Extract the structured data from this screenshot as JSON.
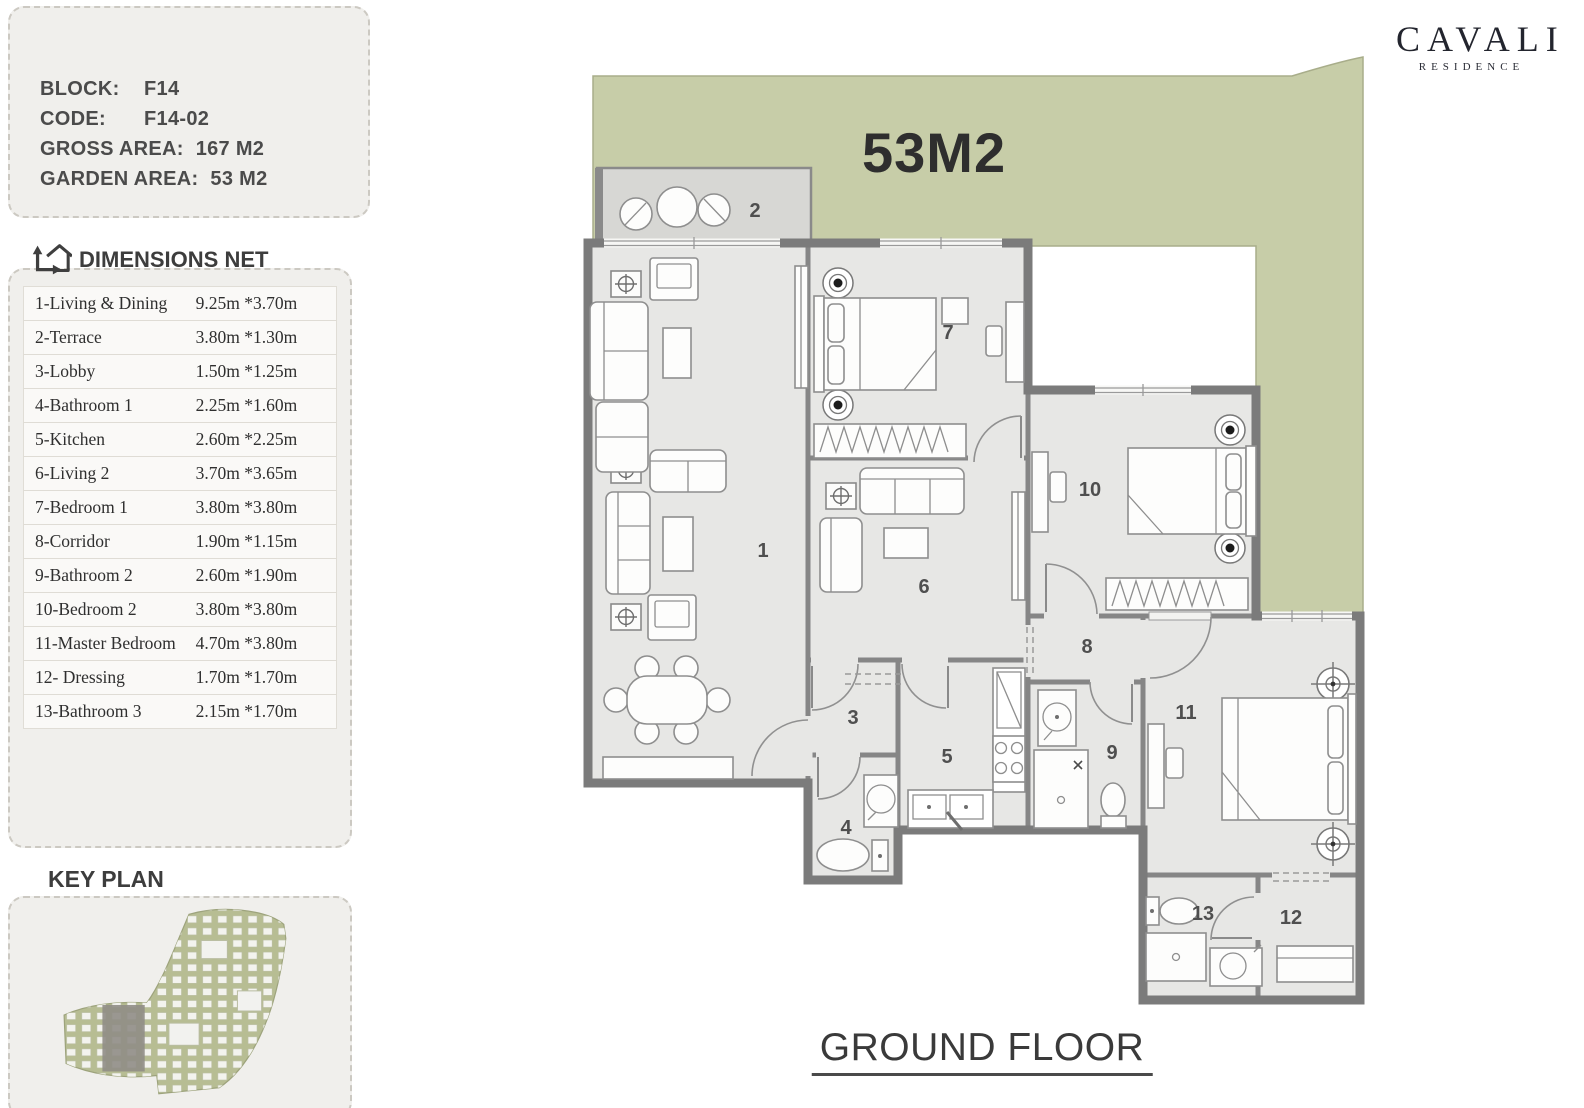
{
  "brand": {
    "name": "CAVALI",
    "subtitle": "RESIDENCE"
  },
  "info_panel": {
    "rows": [
      {
        "label": "BLOCK:",
        "value": "F14"
      },
      {
        "label": "CODE:",
        "value": "F14-02"
      },
      {
        "label": "GROSS AREA:",
        "value": "167 M2"
      },
      {
        "label": "GARDEN AREA:",
        "value": "53 M2"
      }
    ]
  },
  "dimensions": {
    "title": "DIMENSIONS NET",
    "rows": [
      {
        "name": "1-Living & Dining",
        "size": "9.25m *3.70m"
      },
      {
        "name": "2-Terrace",
        "size": "3.80m *1.30m"
      },
      {
        "name": "3-Lobby",
        "size": "1.50m *1.25m"
      },
      {
        "name": "4-Bathroom 1",
        "size": "2.25m *1.60m"
      },
      {
        "name": "5-Kitchen",
        "size": "2.60m *2.25m"
      },
      {
        "name": "6-Living 2",
        "size": "3.70m *3.65m"
      },
      {
        "name": "7-Bedroom 1",
        "size": "3.80m *3.80m"
      },
      {
        "name": "8-Corridor",
        "size": "1.90m *1.15m"
      },
      {
        "name": "9-Bathroom 2",
        "size": "2.60m *1.90m"
      },
      {
        "name": "10-Bedroom 2",
        "size": "3.80m *3.80m"
      },
      {
        "name": "11-Master Bedroom",
        "size": "4.70m *3.80m"
      },
      {
        "name": "12- Dressing",
        "size": "1.70m *1.70m"
      },
      {
        "name": "13-Bathroom 3",
        "size": "2.15m *1.70m"
      }
    ]
  },
  "key_plan": {
    "title": "KEY PLAN"
  },
  "plan": {
    "garden_area_label": "53M2",
    "floor_label": "GROUND FLOOR",
    "room_numbers": [
      {
        "num": "1",
        "x": 763,
        "y": 551
      },
      {
        "num": "2",
        "x": 755,
        "y": 211
      },
      {
        "num": "3",
        "x": 853,
        "y": 718
      },
      {
        "num": "4",
        "x": 846,
        "y": 828
      },
      {
        "num": "5",
        "x": 947,
        "y": 757
      },
      {
        "num": "6",
        "x": 924,
        "y": 587
      },
      {
        "num": "7",
        "x": 948,
        "y": 333
      },
      {
        "num": "8",
        "x": 1087,
        "y": 647
      },
      {
        "num": "9",
        "x": 1112,
        "y": 753
      },
      {
        "num": "10",
        "x": 1090,
        "y": 490
      },
      {
        "num": "11",
        "x": 1186,
        "y": 713
      },
      {
        "num": "12",
        "x": 1291,
        "y": 918
      },
      {
        "num": "13",
        "x": 1203,
        "y": 914
      }
    ]
  },
  "colors": {
    "garden": "#c7cda8",
    "terrace": "#d7d7d4",
    "room_fill": "#e7e7e5",
    "wall": "#7b7b7b",
    "panel_bg": "#f0efec",
    "text_dark": "#3d3d3d"
  }
}
